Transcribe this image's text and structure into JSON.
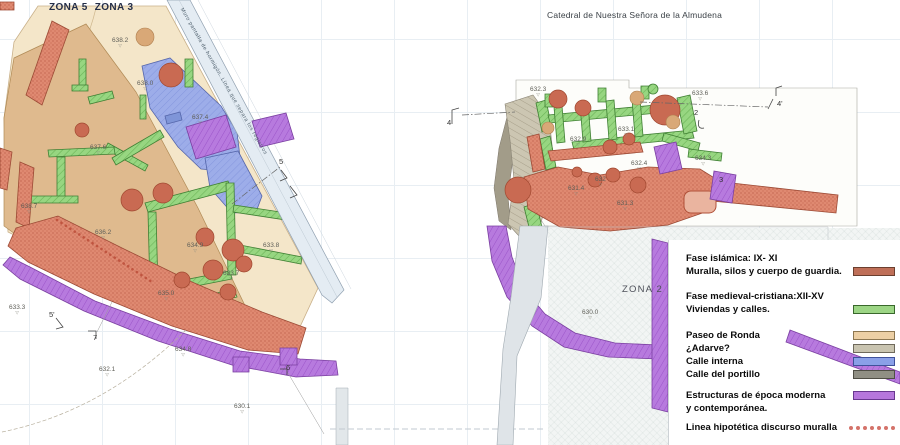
{
  "header": {
    "cathedral_label": "Catedral de Nuestra Señora de la Almudena",
    "zone_left_a": "ZONA 5",
    "zone_left_b": "ZONA 3",
    "zone_right": "ZONA 2",
    "wall_note": "Muro pantalla de hormigón. Línea que separa los registros"
  },
  "elevation_points": [
    {
      "x": 112,
      "y": 37,
      "value": "638.2"
    },
    {
      "x": 137,
      "y": 80,
      "value": "638.0"
    },
    {
      "x": 192,
      "y": 114,
      "value": "637.4"
    },
    {
      "x": 90,
      "y": 144,
      "value": "637.6"
    },
    {
      "x": 21,
      "y": 203,
      "value": "638.7"
    },
    {
      "x": 95,
      "y": 229,
      "value": "636.2"
    },
    {
      "x": 187,
      "y": 242,
      "value": "634.9"
    },
    {
      "x": 263,
      "y": 242,
      "value": "633.8"
    },
    {
      "x": 223,
      "y": 270,
      "value": "633.7"
    },
    {
      "x": 158,
      "y": 290,
      "value": "635.0"
    },
    {
      "x": 9,
      "y": 304,
      "value": "633.3"
    },
    {
      "x": 99,
      "y": 366,
      "value": "632.1"
    },
    {
      "x": 175,
      "y": 346,
      "value": "634.8"
    },
    {
      "x": 234,
      "y": 403,
      "value": "630.1"
    },
    {
      "x": 530,
      "y": 86,
      "value": "632.3"
    },
    {
      "x": 692,
      "y": 90,
      "value": "633.6"
    },
    {
      "x": 618,
      "y": 126,
      "value": "633.1"
    },
    {
      "x": 570,
      "y": 136,
      "value": "632.9"
    },
    {
      "x": 631,
      "y": 160,
      "value": "632.4"
    },
    {
      "x": 568,
      "y": 185,
      "value": "631.4"
    },
    {
      "x": 595,
      "y": 176,
      "value": "632"
    },
    {
      "x": 617,
      "y": 200,
      "value": "631.3"
    },
    {
      "x": 695,
      "y": 155,
      "value": "634.3"
    },
    {
      "x": 582,
      "y": 309,
      "value": "630.0"
    }
  ],
  "section_markers": [
    {
      "x": 49,
      "y": 311,
      "label": "5'"
    },
    {
      "x": 93,
      "y": 334,
      "label": "7"
    },
    {
      "x": 279,
      "y": 158,
      "label": "5"
    },
    {
      "x": 286,
      "y": 364,
      "label": "6"
    },
    {
      "x": 447,
      "y": 119,
      "label": "4"
    },
    {
      "x": 777,
      "y": 100,
      "label": "4'"
    },
    {
      "x": 694,
      "y": 109,
      "label": "2"
    },
    {
      "x": 719,
      "y": 176,
      "label": "3"
    }
  ],
  "legend": {
    "items": [
      {
        "lines": [
          "Fase islámica: IX- XI",
          "Muralla, silos y cuerpo de guardia."
        ],
        "swatch": "#bf6f58",
        "border": "#6b3f2f",
        "align": "bottom",
        "gap": 12,
        "type": "swatch"
      },
      {
        "lines": [
          "Fase medieval-cristiana:XII-XV",
          "Viviendas y calles."
        ],
        "swatch": "#9cd585",
        "border": "#39682c",
        "align": "bottom",
        "gap": 13,
        "type": "swatch"
      },
      {
        "lines": [
          "Paseo de Ronda"
        ],
        "swatch": "#eccfa4",
        "border": "#8d7751",
        "align": "center",
        "gap": 0,
        "type": "swatch"
      },
      {
        "lines": [
          "¿Adarve?"
        ],
        "swatch": "#c9c4b0",
        "border": "#6f6a5c",
        "align": "center",
        "gap": 0,
        "type": "swatch"
      },
      {
        "lines": [
          "Calle interna"
        ],
        "swatch": "#8aa0e8",
        "border": "#3f519b",
        "align": "center",
        "gap": 0,
        "type": "swatch"
      },
      {
        "lines": [
          "Calle del portillo"
        ],
        "swatch": "#908f84",
        "border": "#4f4e45",
        "align": "center",
        "gap": 8,
        "type": "swatch"
      },
      {
        "lines": [
          "Estructuras de época moderna",
          "y contemporánea."
        ],
        "swatch": "#b677dc",
        "border": "#68388f",
        "align": "top",
        "gap": 6,
        "type": "swatch"
      },
      {
        "lines": [
          "Linea hipotética discurso muralla"
        ],
        "swatch": "#d4736a",
        "border": "#d4736a",
        "align": "center",
        "gap": 0,
        "type": "dots"
      }
    ]
  },
  "colors": {
    "islamic": "#bf6f58",
    "medieval": "#9cd585",
    "paseo_de_ronda": "#eccfa4",
    "adarve": "#c9c4b0",
    "calle_interna": "#8aa0e8",
    "calle_del_portillo": "#908f84",
    "moderna": "#b677dc",
    "linea_hipotetica": "#d4736a"
  }
}
